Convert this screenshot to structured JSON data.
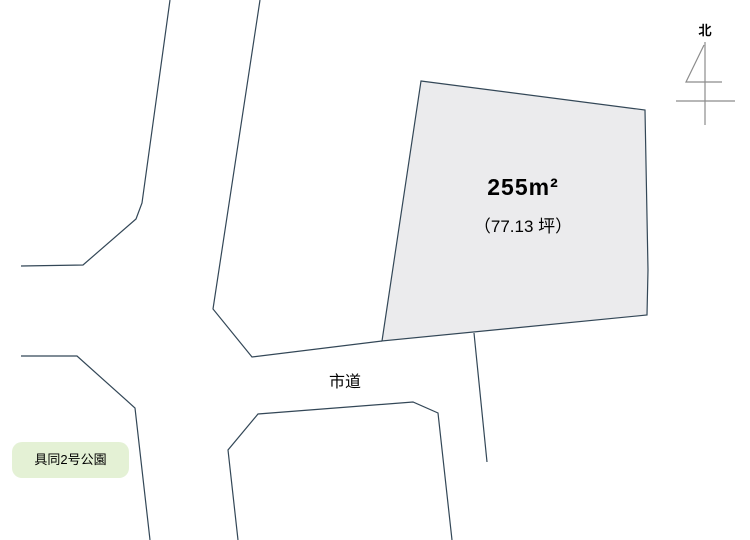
{
  "map": {
    "north_label": "北",
    "road_label": "市道",
    "park_label": "具同2号公園",
    "plot": {
      "area_label": "255m²",
      "tsubo_label": "（77.13 坪）"
    }
  },
  "colors": {
    "background": "#ffffff",
    "line": "#334757",
    "plot_fill": "#ebebed",
    "park_fill": "#e4f1d5",
    "north_arrow": "#8c8c8c",
    "text": "#000000"
  }
}
